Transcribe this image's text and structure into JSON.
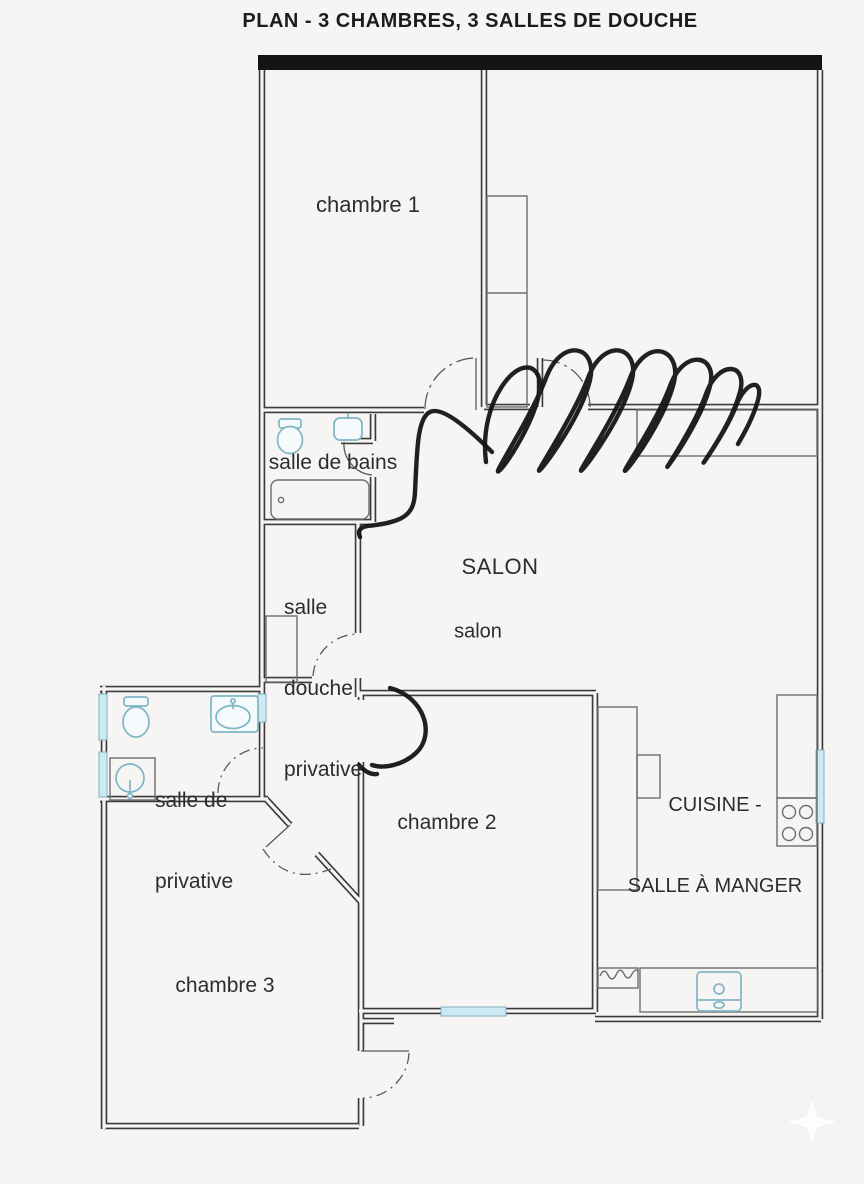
{
  "title": "PLAN - 3 CHAMBRES, 3 SALLES DE DOUCHE",
  "rooms": {
    "chambre1": {
      "label": "chambre 1"
    },
    "salle_de_bains": {
      "label": "salle de bains"
    },
    "salle_douche_privative": {
      "lines": [
        "salle",
        "douche",
        "privative"
      ]
    },
    "salon": {
      "upper": "SALON",
      "lower": "salon"
    },
    "salle_privative": {
      "lines": [
        "salle de",
        "privative"
      ]
    },
    "chambre2": {
      "label": "chambre 2"
    },
    "cuisine": {
      "lines": [
        "CUISINE -",
        "SALLE À MANGER"
      ]
    },
    "chambre3": {
      "label": "chambre 3"
    }
  },
  "fixtures": {
    "salle_de_bains": [
      "toilet-icon",
      "sink-icon",
      "bathtub-icon"
    ],
    "salle_privative": [
      "toilet-icon",
      "sink-icon",
      "washbasin-icon"
    ],
    "cuisine": [
      "stove-4-burner-icon",
      "kitchen-sink-icon",
      "radiator-icon"
    ],
    "storage": [
      "closet-chambre1",
      "closet-salle-douche",
      "counter-salon",
      "kitchen-column",
      "kitchen-counters"
    ]
  },
  "annotations": {
    "pen_scribble": "hand-drawn scribble over top-right wall",
    "pen_path": "hand-drawn line from hallway to private shower room",
    "pen_door_arc": "hand-drawn door swing at chambre 2",
    "north_arrow": "faint compass watermark"
  },
  "colors": {
    "background": "#f6f5f3",
    "wall": "#3b3b3b",
    "window_glass": "#cdeaf2",
    "fixture_blue": "#7fb6c6",
    "pen": "#121212",
    "text": "#2d2d2d"
  }
}
